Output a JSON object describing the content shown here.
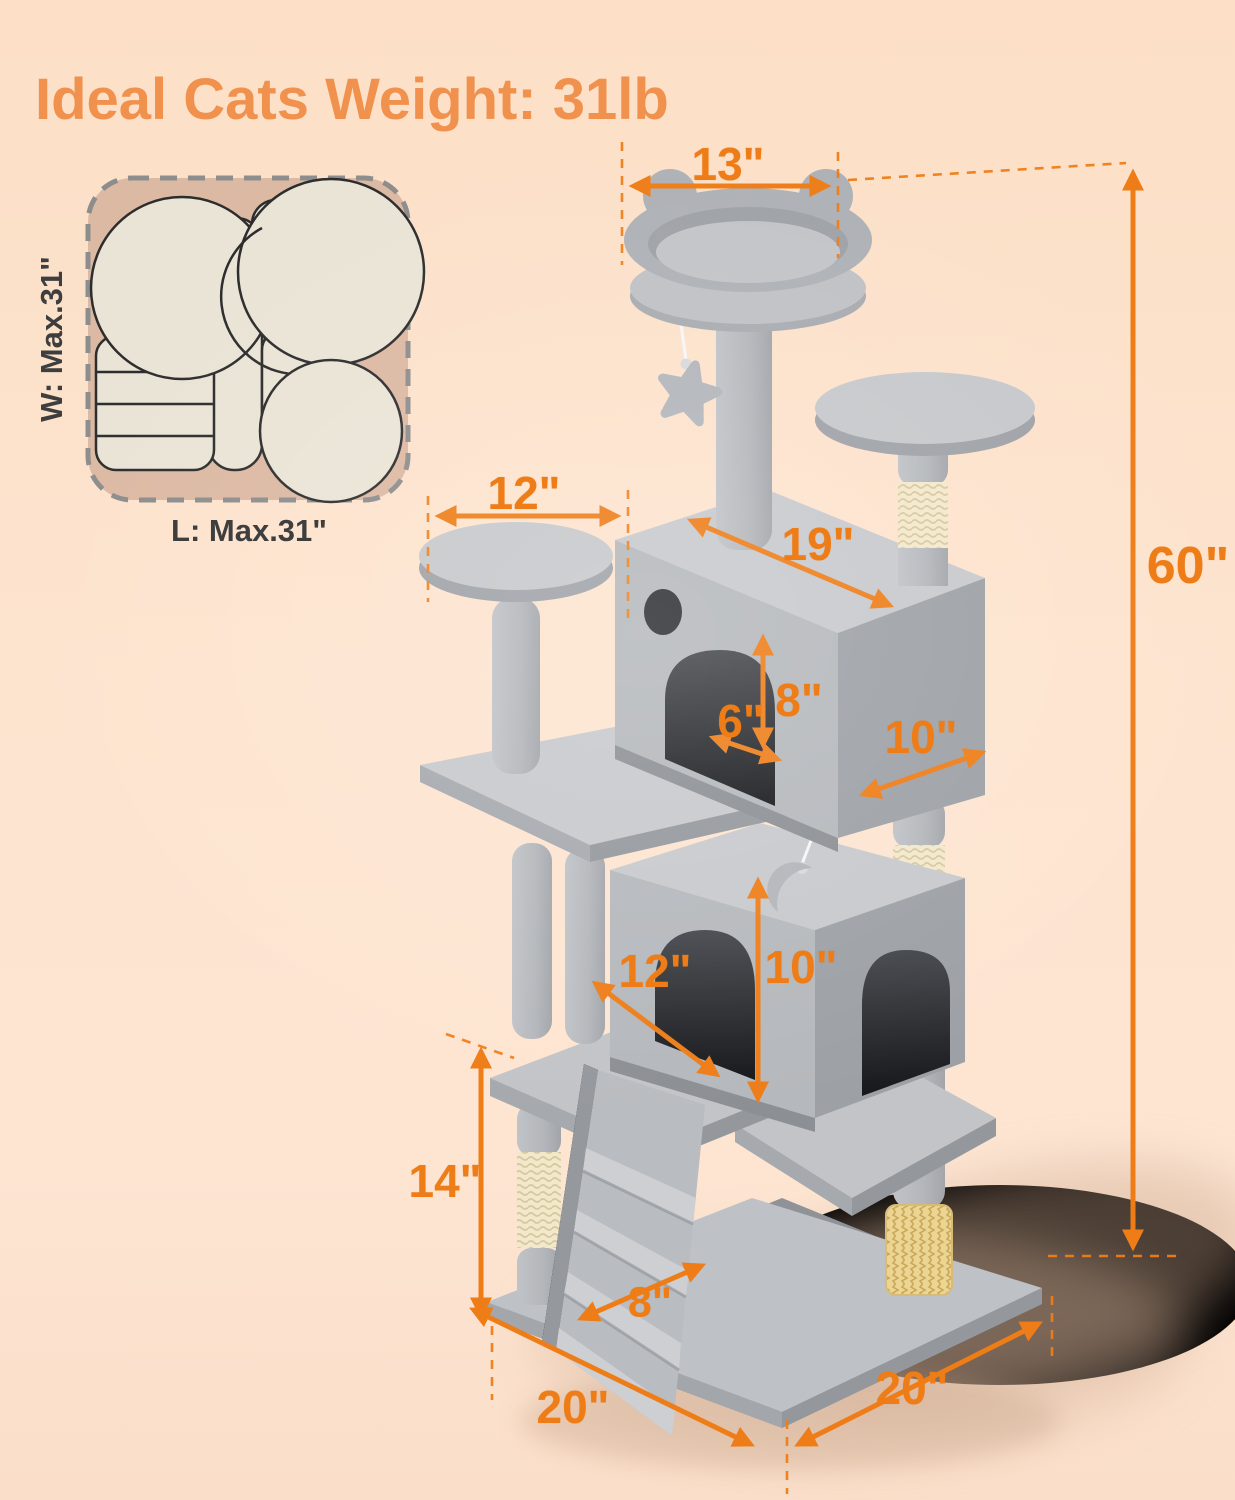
{
  "title": "Ideal Cats Weight: 31lb",
  "footprint": {
    "width_label": "W: Max.31\"",
    "length_label": "L: Max.31\""
  },
  "dimensions": {
    "top_perch_width": "13\"",
    "total_height": "60\"",
    "left_platform_width": "12\"",
    "upper_condo_length": "19\"",
    "upper_condo_entrance_height": "8\"",
    "upper_condo_entrance_width": "6\"",
    "upper_condo_depth": "10\"",
    "lower_condo_width": "12\"",
    "lower_condo_height": "10\"",
    "lower_section_height": "14\"",
    "ramp_width": "8\"",
    "base_length_left": "20\"",
    "base_length_right": "20\""
  },
  "icons": {
    "star_toy": "star-toy-icon",
    "moon_toy": "moon-toy-icon",
    "cat_brush": "cat-brush-icon",
    "scratching_post": "sisal-scratching-post"
  },
  "colors": {
    "dimension_accent": "#ee7d18",
    "title": "#f0914e",
    "background": "#fcdfc6",
    "tree_gray": "#b5b8bc",
    "tree_gray_light": "#c7c9cd",
    "tree_gray_dark": "#9da1a6",
    "sisal": "#f2e8cc",
    "brush": "#ecd493",
    "footprint_fill": "#dcb9a3",
    "footprint_shape": "#eae4d6"
  }
}
